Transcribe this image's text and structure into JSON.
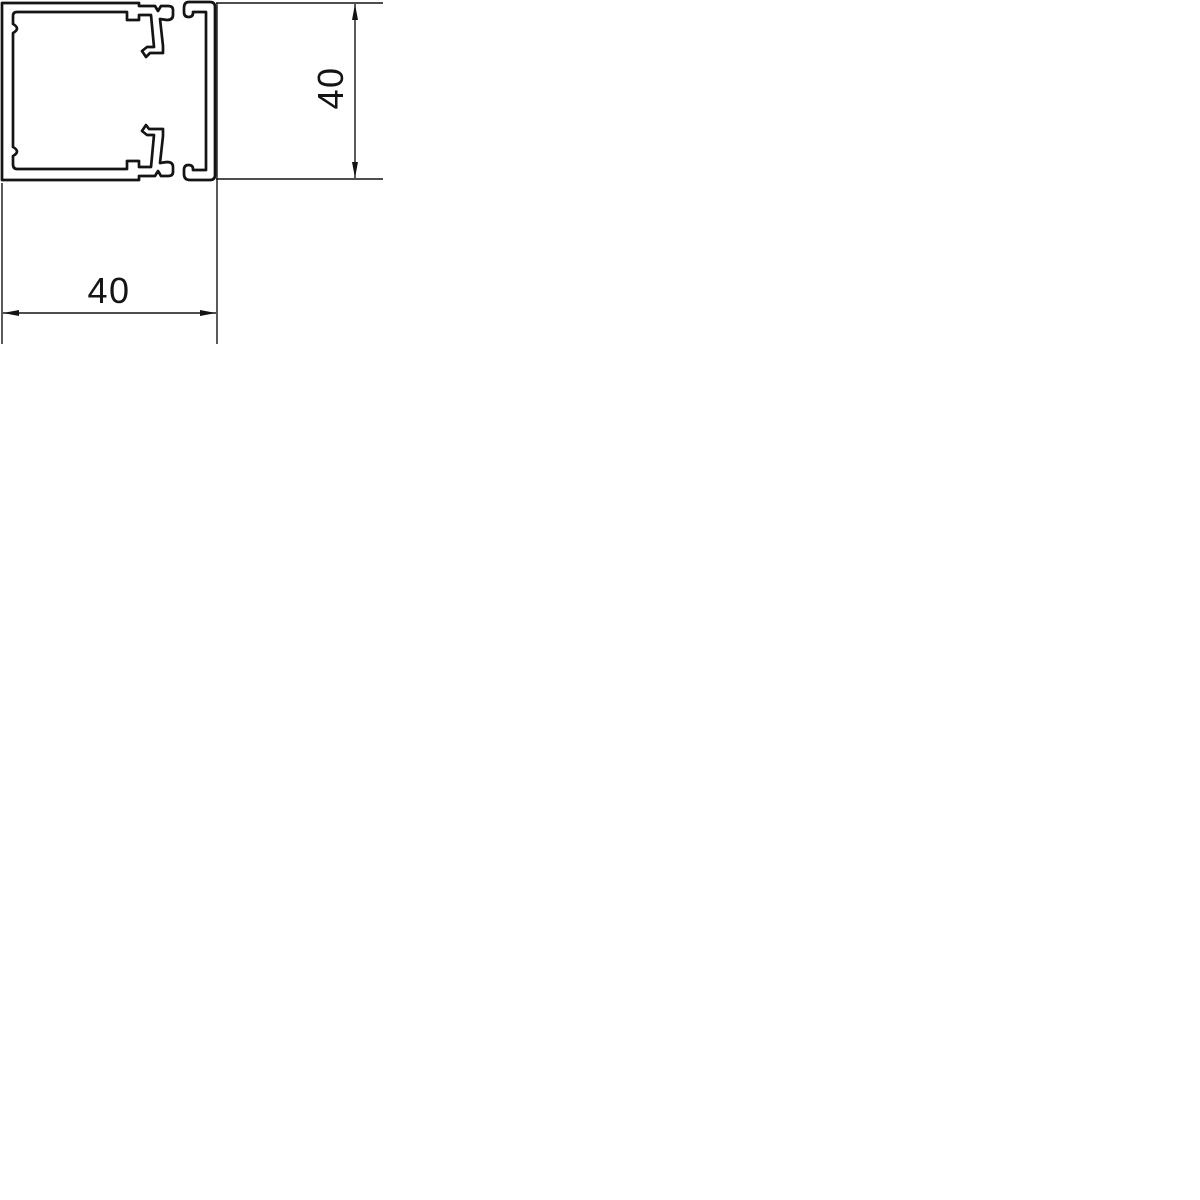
{
  "drawing": {
    "background_color": "#ffffff",
    "line_color": "#141414",
    "width_dimension": {
      "value": "40"
    },
    "height_dimension": {
      "value": "40"
    }
  }
}
